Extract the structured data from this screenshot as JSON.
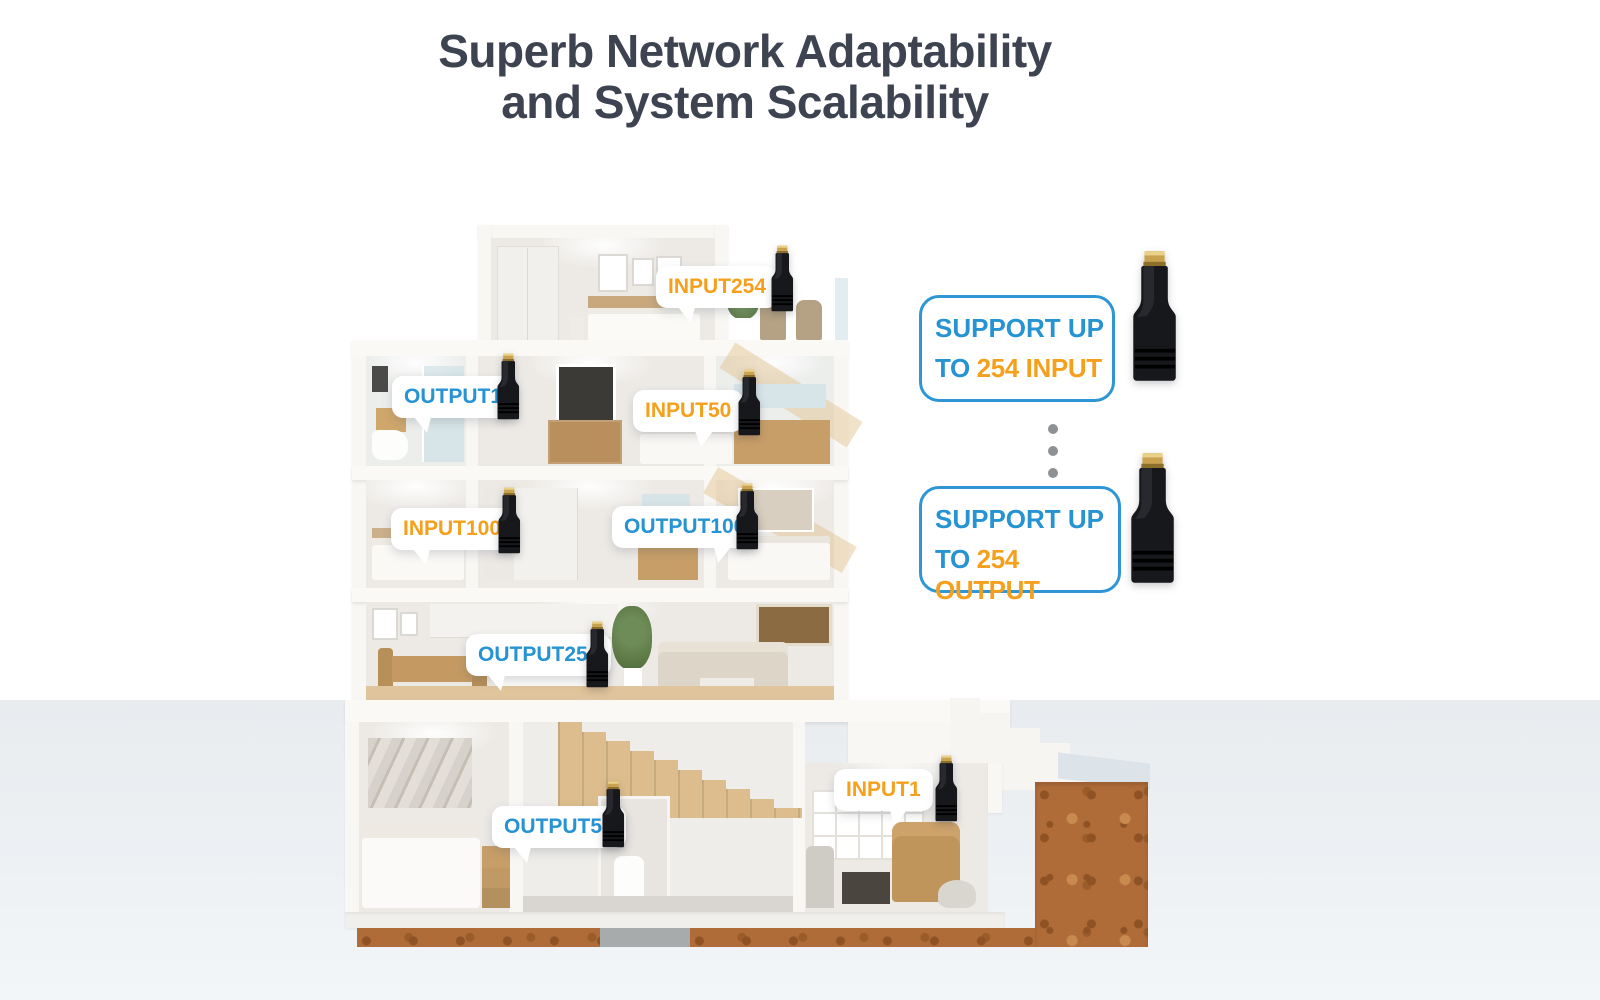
{
  "title": {
    "line1": "Superb Network Adaptability",
    "line2": "and System Scalability"
  },
  "house": {
    "description": "five-storey cutaway dollhouse cross-section on soil",
    "labels": [
      {
        "id": "input254",
        "text": "INPUT254",
        "type": "input"
      },
      {
        "id": "output1",
        "text": "OUTPUT1",
        "type": "output"
      },
      {
        "id": "input50",
        "text": "INPUT50",
        "type": "input"
      },
      {
        "id": "input100",
        "text": "INPUT100",
        "type": "input"
      },
      {
        "id": "output100",
        "text": "OUTPUT100",
        "type": "output"
      },
      {
        "id": "output254",
        "text": "OUTPUT254",
        "type": "output"
      },
      {
        "id": "output50",
        "text": "OUTPUT50",
        "type": "output"
      },
      {
        "id": "input1",
        "text": "INPUT1",
        "type": "input"
      }
    ]
  },
  "panel": {
    "box1": {
      "line1": "SUPPORT UP",
      "line2_prefix": "TO ",
      "line2_highlight": "254 INPUT"
    },
    "box2": {
      "line1": "SUPPORT UP",
      "line2_prefix": "TO ",
      "line2_highlight": "254 OUTPUT"
    }
  },
  "icons": {
    "device": "hdmi-extender-dongle",
    "separator": "vertical-ellipsis-dots"
  },
  "colors": {
    "input_orange": "#f5a01d",
    "output_blue": "#2693d2",
    "panel_border_blue": "#2e96d5",
    "title_text": "#3d4350",
    "soil_brown": "#b06c38",
    "ground_gray": "#edf1f4"
  }
}
